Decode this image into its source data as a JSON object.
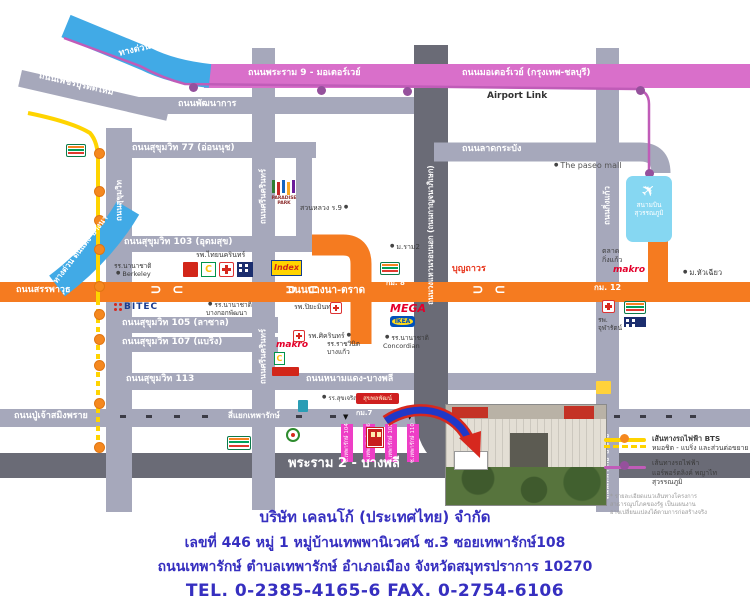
{
  "colors": {
    "road": "#a6a8bb",
    "road_dark": "#6a6b76",
    "orange": "#f57b20",
    "pink": "#d96fca",
    "blue_expwy": "#41aae6",
    "bts_yellow": "#ffd400",
    "station_orange": "#f5881f",
    "airport_link_line": "#c05cb8",
    "airport_link_dot": "#95519c",
    "soi_pink": "#ee3ec6",
    "address_blue": "#362fc0",
    "arrow_red": "#d6281e",
    "arrow_blue": "#2038c8"
  },
  "airport": {
    "line1": "สนามบิน",
    "line2": "สุวรรณภูมิ",
    "icon": "airplane-icon"
  },
  "legend": {
    "bts_line1": "เส้นทางรถไฟฟ้า BTS",
    "bts_line2": "หมอชิต - แบริ่ง และส่วนต่อขยาย",
    "al_line1": "เส้นทางรถไฟฟ้า",
    "al_line2": "แอร์พอร์ตลิงค์ พญาไท สุวรรณภูมิ",
    "note1": "* รายละเอียดแนวเส้นทางโครงการ",
    "note2": "สาธารณูปโภคของรัฐ เป็นแผนงาน",
    "note3": "อาจเปลี่ยนแปลงได้ตามการก่อสร้างจริง"
  },
  "address": {
    "company": "บริษัท เคลนโก้ (ประเทศไทย) จำกัด",
    "line1": "เลขที่  446  หมู่ 1 หมู่บ้านเทพพานิเวศน์ ซ.3   ซอยเทพารักษ์108",
    "line2": "ถนนเทพารักษ์  ตำบลเทพารักษ์  อำเภอเมือง  จังหวัดสมุทรปราการ  10270",
    "phone": "TEL. 0-2385-4165-6   FAX. 0-2754-6106"
  },
  "map": {
    "roads": [
      {
        "id": "phetchaburi-tat-mai",
        "x": 22,
        "y": 70,
        "w": 152,
        "h": 17,
        "c": "road",
        "rot": 13,
        "z": 1
      },
      {
        "id": "phatthanakan",
        "x": 138,
        "y": 97,
        "w": 296,
        "h": 17,
        "c": "road",
        "z": 1
      },
      {
        "id": "sukhumvit-77",
        "x": 128,
        "y": 142,
        "w": 188,
        "h": 16,
        "c": "road",
        "z": 1
      },
      {
        "id": "sukhumvit-103",
        "x": 106,
        "y": 236,
        "w": 246,
        "h": 16,
        "c": "road",
        "z": 1
      },
      {
        "id": "sukhumvit-105",
        "x": 106,
        "y": 317,
        "w": 172,
        "h": 16,
        "c": "road",
        "z": 1
      },
      {
        "id": "sukhumvit-107",
        "x": 106,
        "y": 337,
        "w": 172,
        "h": 15,
        "c": "road",
        "z": 1
      },
      {
        "id": "namdaeng-bangphli",
        "x": 106,
        "y": 373,
        "w": 512,
        "h": 17,
        "c": "road",
        "z": 1
      },
      {
        "id": "thepharak",
        "x": 0,
        "y": 409,
        "w": 750,
        "h": 18,
        "c": "road",
        "z": 1
      },
      {
        "id": "rama2-bangphli",
        "x": 0,
        "y": 453,
        "w": 750,
        "h": 25,
        "c": "road_dark",
        "z": 1
      },
      {
        "id": "sukhumvit-vertical",
        "x": 106,
        "y": 128,
        "w": 26,
        "h": 384,
        "c": "road",
        "z": 1
      },
      {
        "id": "srinakarin-vertical",
        "x": 252,
        "y": 48,
        "w": 23,
        "h": 462,
        "c": "road",
        "z": 1
      },
      {
        "id": "kingkaew-vertical",
        "x": 596,
        "y": 48,
        "w": 23,
        "h": 464,
        "c": "road",
        "z": 1
      },
      {
        "id": "paradise-park-link",
        "x": 296,
        "y": 150,
        "w": 16,
        "h": 96,
        "c": "road",
        "z": 1
      },
      {
        "id": "motorway",
        "x": 204,
        "y": 64,
        "w": 546,
        "h": 24,
        "c": "pink",
        "z": 2
      },
      {
        "id": "bangna-trat",
        "x": 0,
        "y": 282,
        "w": 750,
        "h": 20,
        "c": "orange",
        "z": 2
      },
      {
        "id": "airport-connector",
        "x": 648,
        "y": 238,
        "w": 20,
        "h": 47,
        "c": "orange",
        "z": 2
      }
    ],
    "road_labels": [
      {
        "id": "srirat-expwy",
        "t": "ทางด่วนศรีรัช",
        "x": 118,
        "y": 50,
        "s": 9,
        "col": "w",
        "r": -13
      },
      {
        "id": "rama9-motorway",
        "t": "ถนนพระราม 9 - มอเตอร์เวย์",
        "x": 248,
        "y": 69,
        "s": 9,
        "col": "w"
      },
      {
        "id": "motorway",
        "t": "ถนนมอเตอร์เวย์ (กรุงเทพ-ชลบุรี)",
        "x": 462,
        "y": 69,
        "s": 9,
        "col": "w"
      },
      {
        "id": "phetchaburi",
        "t": "ถนนเพชรบุรีตัดใหม่",
        "x": 40,
        "y": 72,
        "s": 9,
        "col": "w",
        "r": 13
      },
      {
        "id": "phatthanakan",
        "t": "ถนนพัฒนาการ",
        "x": 178,
        "y": 100,
        "s": 9,
        "col": "w"
      },
      {
        "id": "airport-link",
        "t": "Airport Link",
        "x": 487,
        "y": 92,
        "s": 9,
        "col": "#333"
      },
      {
        "id": "lat-krabang",
        "t": "ถนนลาดกระบัง",
        "x": 462,
        "y": 145,
        "s": 9,
        "col": "w"
      },
      {
        "id": "sukhumvit-77",
        "t": "ถนนสุขุมวิท 77 (อ่อนนุช)",
        "x": 132,
        "y": 144,
        "s": 9,
        "col": "w"
      },
      {
        "id": "sukhumvit-103",
        "t": "ถนนสุขุมวิท 103 (อุดมสุข)",
        "x": 124,
        "y": 238,
        "s": 9,
        "col": "w"
      },
      {
        "id": "sukhumvit-105",
        "t": "ถนนสุขุมวิท 105 (ลาซาล)",
        "x": 122,
        "y": 319,
        "s": 9,
        "col": "w"
      },
      {
        "id": "sukhumvit-107",
        "t": "ถนนสุขุมวิท 107 (แบริ่ง)",
        "x": 122,
        "y": 338,
        "s": 9,
        "col": "w"
      },
      {
        "id": "sukhumvit-113",
        "t": "ถนนสุขุมวิท 113",
        "x": 126,
        "y": 375,
        "s": 9,
        "col": "w"
      },
      {
        "id": "sanphawut",
        "t": "ถนนสรรพาวุธ",
        "x": 16,
        "y": 286,
        "s": 9,
        "col": "w"
      },
      {
        "id": "bangna-trat",
        "t": "ถนนบางนา-ตราด",
        "x": 288,
        "y": 285,
        "s": 10,
        "col": "w"
      },
      {
        "id": "km8",
        "t": "กม. 8",
        "x": 386,
        "y": 280,
        "s": 7,
        "col": "w"
      },
      {
        "id": "km12",
        "t": "กม. 12",
        "x": 594,
        "y": 284,
        "s": 8,
        "col": "w"
      },
      {
        "id": "namdaeng-bangphli",
        "t": "ถนนหนามแดง-บางพลี",
        "x": 306,
        "y": 375,
        "s": 9,
        "col": "w"
      },
      {
        "id": "puchao-samingphrai",
        "t": "ถนนปู่เจ้าสมิงพราย",
        "x": 14,
        "y": 412,
        "s": 9,
        "col": "w"
      },
      {
        "id": "yaek-thepharak",
        "t": "สี่แยกเทพารักษ์",
        "x": 228,
        "y": 412,
        "s": 8,
        "col": "w"
      },
      {
        "id": "km7",
        "t": "กม.7",
        "x": 356,
        "y": 410,
        "s": 7,
        "col": "w"
      },
      {
        "id": "rama2-bangphli",
        "t": "พระราม 2 - บางพลี",
        "x": 288,
        "y": 457,
        "s": 13,
        "col": "w"
      },
      {
        "id": "dindaeng-bangna-expwy",
        "t": "ทางด่วน ดินแดง-บางนา",
        "x": 52,
        "y": 280,
        "s": 8,
        "col": "w",
        "r": -52
      },
      {
        "id": "sukhumvit-v",
        "t": "ถนนสุขุมวิท",
        "x": 119,
        "y": 200,
        "s": 8,
        "col": "w",
        "v": 1
      },
      {
        "id": "srinakarin-v1",
        "t": "ถนนศรีนครินทร์",
        "x": 263,
        "y": 196,
        "s": 8,
        "col": "w",
        "v": 1
      },
      {
        "id": "srinakarin-v2",
        "t": "ถนนศรีนครินทร์",
        "x": 263,
        "y": 356,
        "s": 8,
        "col": "w",
        "v": 1
      },
      {
        "id": "kanchanaphisek-v",
        "t": "ถนนวงแหวนรอบนอก (ถนนกาญจนาภิเษก)",
        "x": 431,
        "y": 235,
        "s": 7.5,
        "col": "w",
        "v": 1
      },
      {
        "id": "kingkaew-v",
        "t": "ถนนกิ่งแก้ว",
        "x": 607,
        "y": 205,
        "s": 8,
        "col": "w",
        "v": 1
      },
      {
        "id": "thepharak-bangbo-v",
        "t": "ถนนเทพารักษ์-บางบ่อ",
        "x": 607,
        "y": 467,
        "s": 7,
        "col": "w",
        "v": 1
      }
    ],
    "landmarks": [
      {
        "id": "paseo-mall",
        "lines": [
          "The paseo mall"
        ],
        "x": 552,
        "y": 161,
        "s": 8,
        "dot": "l",
        "col": "#555"
      },
      {
        "id": "suan-luang-r9",
        "lines": [
          "สวนหลวง ร.9"
        ],
        "x": 300,
        "y": 204,
        "s": 7,
        "dot": "r"
      },
      {
        "id": "ram2-university",
        "lines": [
          "ม.ราม2"
        ],
        "x": 388,
        "y": 243,
        "s": 7,
        "dot": "l"
      },
      {
        "id": "boonthavorn",
        "lines": [
          "บุญถาวร"
        ],
        "x": 452,
        "y": 264,
        "s": 9,
        "col": "#e8351c",
        "bold": 1
      },
      {
        "id": "berkeley-school",
        "lines": [
          "รร.นานาชาติ",
          "Berkeley"
        ],
        "x": 114,
        "y": 262,
        "s": 6.5,
        "dot": "l2"
      },
      {
        "id": "thainakarin-hospital",
        "lines": [
          "รพ.ไทยนครินทร์"
        ],
        "x": 196,
        "y": 251,
        "s": 7
      },
      {
        "id": "bangkok-patana-school",
        "lines": [
          "รร.นานาชาติ",
          "บางกอกพัฒนา"
        ],
        "x": 206,
        "y": 301,
        "s": 6.5,
        "dot": "l"
      },
      {
        "id": "piyamin-hospital",
        "lines": [
          "รพ.ปิยะมินทร์"
        ],
        "x": 294,
        "y": 303,
        "s": 7
      },
      {
        "id": "sikarin-hospital",
        "lines": [
          "รพ.ศิครินทร์"
        ],
        "x": 308,
        "y": 332,
        "s": 7,
        "dot": "r"
      },
      {
        "id": "ratwinit-bangkaeo-school",
        "lines": [
          "รร.ราชวินิต",
          "บางแก้ว"
        ],
        "x": 327,
        "y": 340,
        "s": 6.5
      },
      {
        "id": "concordian-school",
        "lines": [
          "รร.นานาชาติ",
          "Concordian"
        ],
        "x": 383,
        "y": 334,
        "s": 6.5,
        "dot": "l"
      },
      {
        "id": "sukcharoenphon-school",
        "lines": [
          "รร.สุขเจริญผล"
        ],
        "x": 320,
        "y": 394,
        "s": 6,
        "dot": "l"
      },
      {
        "id": "kingkaew-market",
        "lines": [
          "ตลาด",
          "กิ่งแก้ว"
        ],
        "x": 602,
        "y": 247,
        "s": 7
      },
      {
        "id": "huachiew-university",
        "lines": [
          "ม.หัวเฉียว"
        ],
        "x": 681,
        "y": 268,
        "s": 7.5,
        "dot": "l"
      },
      {
        "id": "chularat-hospital",
        "lines": [
          "รพ.",
          "จุฬารัตน์"
        ],
        "x": 598,
        "y": 316,
        "s": 6.5
      }
    ],
    "logos": [
      {
        "k": "sev",
        "x": 66,
        "y": 144,
        "w": 20,
        "h": 13,
        "label": "7"
      },
      {
        "k": "paradise",
        "x": 268,
        "y": 180,
        "w": 32,
        "h": 34,
        "label": "PARADISE PARK"
      },
      {
        "k": "sev",
        "x": 380,
        "y": 262,
        "w": 20,
        "h": 13,
        "label": "7"
      },
      {
        "k": "tile",
        "x": 183,
        "y": 262,
        "w": 15,
        "h": 15,
        "bg": "#d22619"
      },
      {
        "k": "greenC",
        "x": 201,
        "y": 262,
        "w": 15,
        "h": 15,
        "label": "C"
      },
      {
        "k": "cross",
        "x": 219,
        "y": 262,
        "w": 15,
        "h": 15
      },
      {
        "k": "navy",
        "x": 237,
        "y": 262,
        "w": 16,
        "h": 15
      },
      {
        "k": "index",
        "x": 271,
        "y": 260,
        "w": 31,
        "h": 16,
        "label": "Index"
      },
      {
        "k": "bitec",
        "x": 114,
        "y": 302,
        "w": 40,
        "h": 14,
        "label": "BITEC"
      },
      {
        "k": "cross",
        "x": 330,
        "y": 302,
        "w": 12,
        "h": 12
      },
      {
        "k": "mega",
        "x": 390,
        "y": 302,
        "w": 32,
        "h": 11,
        "label": "MEGA"
      },
      {
        "k": "ikea",
        "x": 390,
        "y": 316,
        "w": 25,
        "h": 11,
        "label": "IKEA"
      },
      {
        "k": "makro",
        "x": 276,
        "y": 340,
        "w": 26,
        "h": 9,
        "label": "makro"
      },
      {
        "k": "cross",
        "x": 293,
        "y": 330,
        "w": 12,
        "h": 12
      },
      {
        "k": "greenC",
        "x": 274,
        "y": 352,
        "w": 11,
        "h": 13,
        "label": "C"
      },
      {
        "k": "tile",
        "x": 272,
        "y": 367,
        "w": 27,
        "h": 9,
        "bg": "#d22619"
      },
      {
        "k": "tile",
        "x": 298,
        "y": 400,
        "w": 10,
        "h": 12,
        "bg": "#2a9db5"
      },
      {
        "k": "badge",
        "x": 356,
        "y": 393,
        "w": 43,
        "h": 11,
        "label": "สุขพลพัฒน์"
      },
      {
        "k": "round",
        "x": 286,
        "y": 428,
        "w": 14,
        "h": 14
      },
      {
        "k": "sev",
        "x": 227,
        "y": 436,
        "w": 24,
        "h": 14,
        "label": "7"
      },
      {
        "k": "makro",
        "x": 613,
        "y": 265,
        "w": 26,
        "h": 9,
        "label": "makro"
      },
      {
        "k": "cross",
        "x": 602,
        "y": 300,
        "w": 13,
        "h": 13
      },
      {
        "k": "sev",
        "x": 624,
        "y": 301,
        "w": 22,
        "h": 13,
        "label": "7"
      },
      {
        "k": "navy",
        "x": 624,
        "y": 317,
        "w": 22,
        "h": 10
      },
      {
        "k": "tile",
        "x": 596,
        "y": 381,
        "w": 15,
        "h": 13,
        "bg": "#ffd23b"
      },
      {
        "k": "dest",
        "x": 367,
        "y": 428,
        "w": 16,
        "h": 19
      }
    ],
    "sois": {
      "y": 424,
      "h": 38,
      "w": 12,
      "bars": [
        {
          "x": 341,
          "label": "ซ.เทพารักษ์ 104"
        },
        {
          "x": 363,
          "label": "ซ.เทพารักษ์ 106"
        },
        {
          "x": 385,
          "label": "ซ.เทพารักษ์ 108"
        },
        {
          "x": 407,
          "label": "ซ.เทพารักษ์ 110"
        }
      ],
      "arrows": [
        343,
        407
      ]
    },
    "transit": {
      "bts_x": 98,
      "bts_station_ys": [
        152,
        190,
        219,
        248,
        285,
        313,
        338,
        364,
        402,
        446
      ],
      "airport_link_dots": [
        [
          193,
          87
        ],
        [
          321,
          90
        ],
        [
          407,
          91
        ],
        [
          640,
          90
        ],
        [
          649,
          173
        ]
      ]
    },
    "uturns": [
      {
        "x": 150,
        "g": "⊃"
      },
      {
        "x": 172,
        "g": "⊂"
      },
      {
        "x": 285,
        "g": "⊃"
      },
      {
        "x": 307,
        "g": "⊂"
      },
      {
        "x": 472,
        "g": "⊃"
      },
      {
        "x": 494,
        "g": "⊂"
      }
    ],
    "stop_xs": [
      120,
      146,
      174,
      202,
      296,
      330,
      398,
      588,
      614,
      640,
      666,
      690
    ]
  }
}
